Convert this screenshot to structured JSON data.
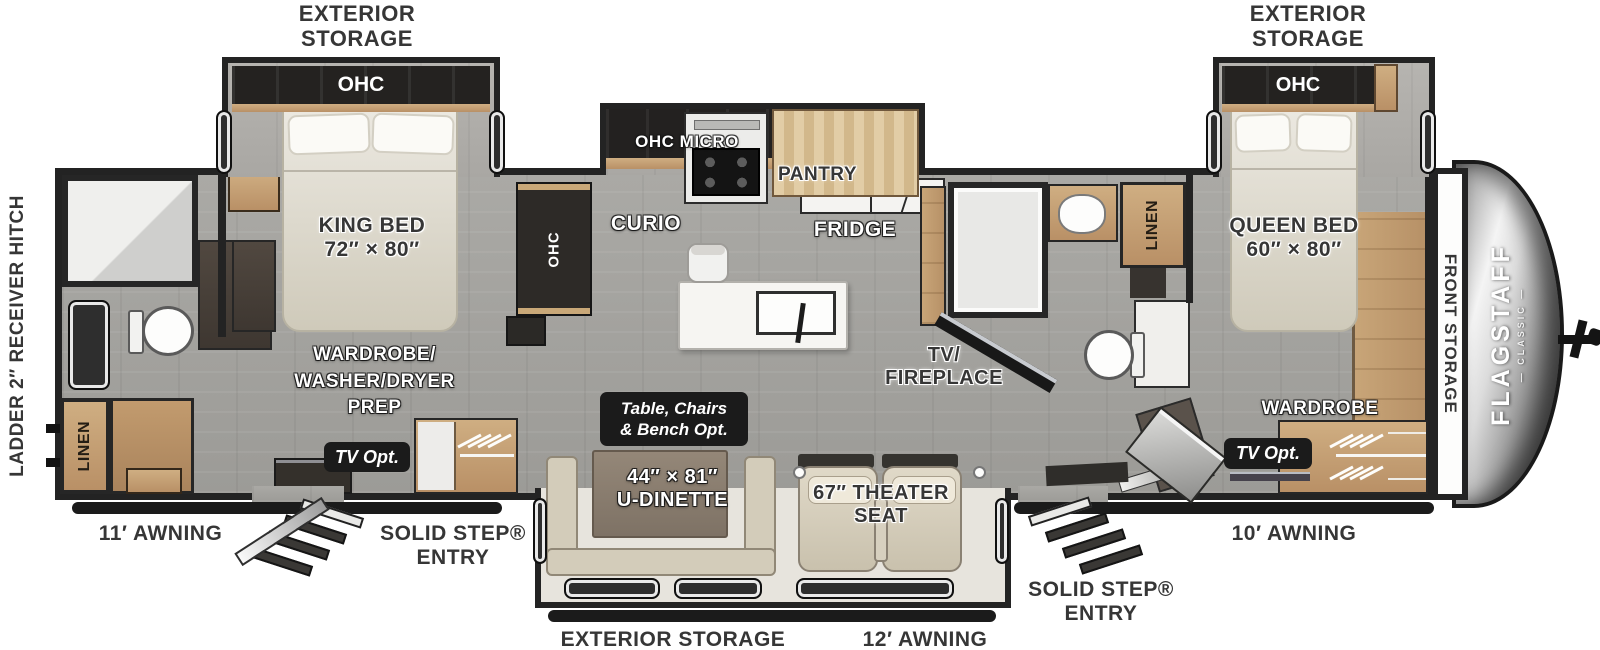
{
  "colors": {
    "wall": "#232323",
    "label_dark": "#363636",
    "chip_bg": "#1b1b1b",
    "wood": "#c9a878",
    "beige": "#d9d3c5",
    "floor_gray": "#a6a49f"
  },
  "exterior": {
    "storage_top_left": [
      "EXTERIOR",
      "STORAGE"
    ],
    "storage_top_right": [
      "EXTERIOR",
      "STORAGE"
    ],
    "storage_bottom": "EXTERIOR STORAGE",
    "awning_left": "11′ AWNING",
    "awning_bottom": "12′ AWNING",
    "awning_right": "10′ AWNING",
    "entry_left": [
      "SOLID STEP®",
      "ENTRY"
    ],
    "entry_right": [
      "SOLID STEP®",
      "ENTRY"
    ],
    "rear": "LADDER    2″ RECEIVER HITCH",
    "front_storage": "FRONT STORAGE"
  },
  "brand": {
    "name": "FLAGSTAFF",
    "series": "— CLASSIC —"
  },
  "bedroom_left": {
    "ohc": "OHC",
    "bed": [
      "KING BED",
      "72″ × 80″"
    ],
    "wardrobe_prep": [
      "WARDROBE/",
      "WASHER/DRYER",
      "PREP"
    ],
    "tv_opt": "TV Opt."
  },
  "bathroom_left": {
    "linen": "LINEN"
  },
  "kitchen": {
    "ohc_side": "OHC",
    "curio": "CURIO",
    "ohc_micro": "OHC  MICRO",
    "pantry": "PANTRY",
    "fridge": "FRIDGE"
  },
  "living": {
    "tv_fireplace": [
      "TV/",
      "FIREPLACE"
    ],
    "dinette_opt": [
      "Table, Chairs",
      "& Bench  Opt."
    ],
    "dinette": [
      "44″ × 81″",
      "U-DINETTE"
    ],
    "theater": [
      "67″ THEATER",
      "SEAT"
    ]
  },
  "bathroom_mid": {
    "linen": "LINEN"
  },
  "bedroom_right": {
    "ohc": "OHC",
    "bed": [
      "QUEEN BED",
      "60″ × 80″"
    ],
    "wardrobe": "WARDROBE",
    "tv_opt": "TV Opt."
  }
}
